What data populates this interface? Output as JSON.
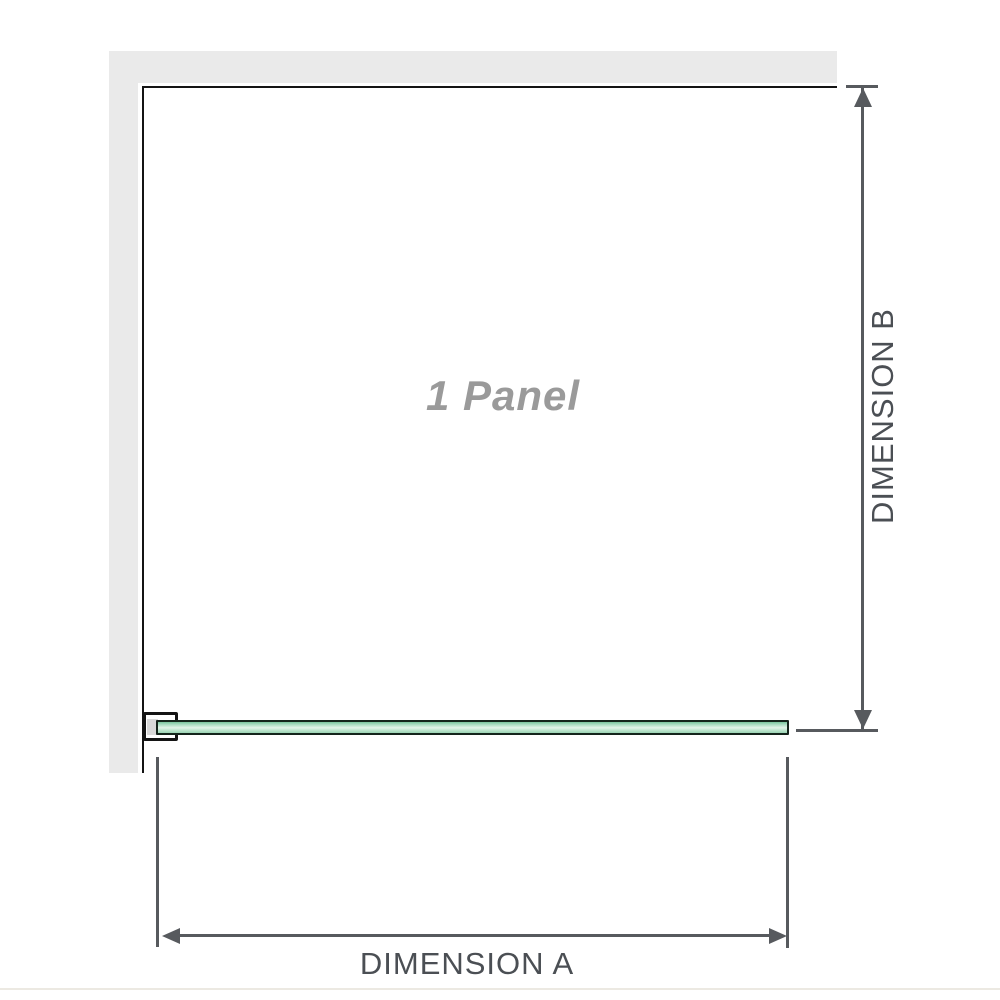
{
  "diagram": {
    "title": "1 panel shower screen dimension diagram",
    "panel_label": "1 Panel",
    "dimension_a_label": "DIMENSION A",
    "dimension_b_label": "DIMENSION B",
    "colors": {
      "wall_gray": "#eaeaea",
      "panel_outline_black": "#141414",
      "glass_green": "#a9dcc1",
      "glass_green_dark": "#79c49c",
      "glass_green_light": "#e3f4e9",
      "bracket_spacer_gray": "#d9d9d9",
      "dimension_line_gray": "#575a5e",
      "dimension_text_gray": "#4b4f54",
      "watermark_gray": "#9a9a9a",
      "baseline_rule": "#ece9e2"
    }
  }
}
